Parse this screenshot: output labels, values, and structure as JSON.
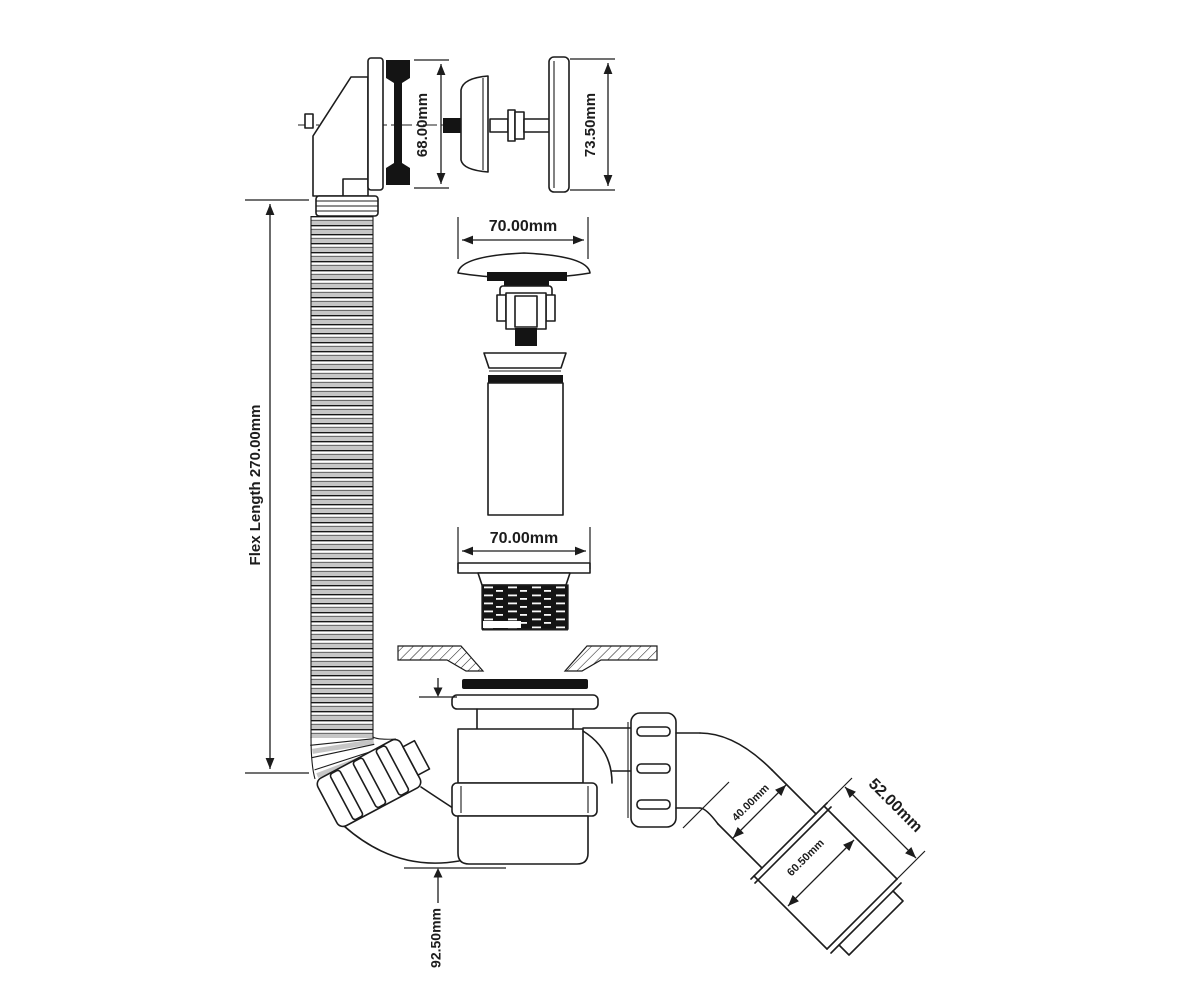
{
  "diagram": {
    "type": "technical-drawing",
    "subject": "bath-waste-overflow-trap-assembly",
    "dims": {
      "overflow_gasket_diameter": "68.00mm",
      "overflow_plate_diameter": "73.50mm",
      "plug_diameter": "70.00mm",
      "flange_diameter": "70.00mm",
      "flex_length": "Flex Length 270.00mm",
      "trap_height": "92.50mm",
      "outlet_bore": "40.00mm",
      "outlet_length": "52.00mm",
      "adaptor_diameter": "60.50mm"
    },
    "colors": {
      "line": "#1c1c1c",
      "paper": "#ffffff",
      "hose_shade": "#c6c6c6",
      "rubber": "#141414"
    }
  }
}
